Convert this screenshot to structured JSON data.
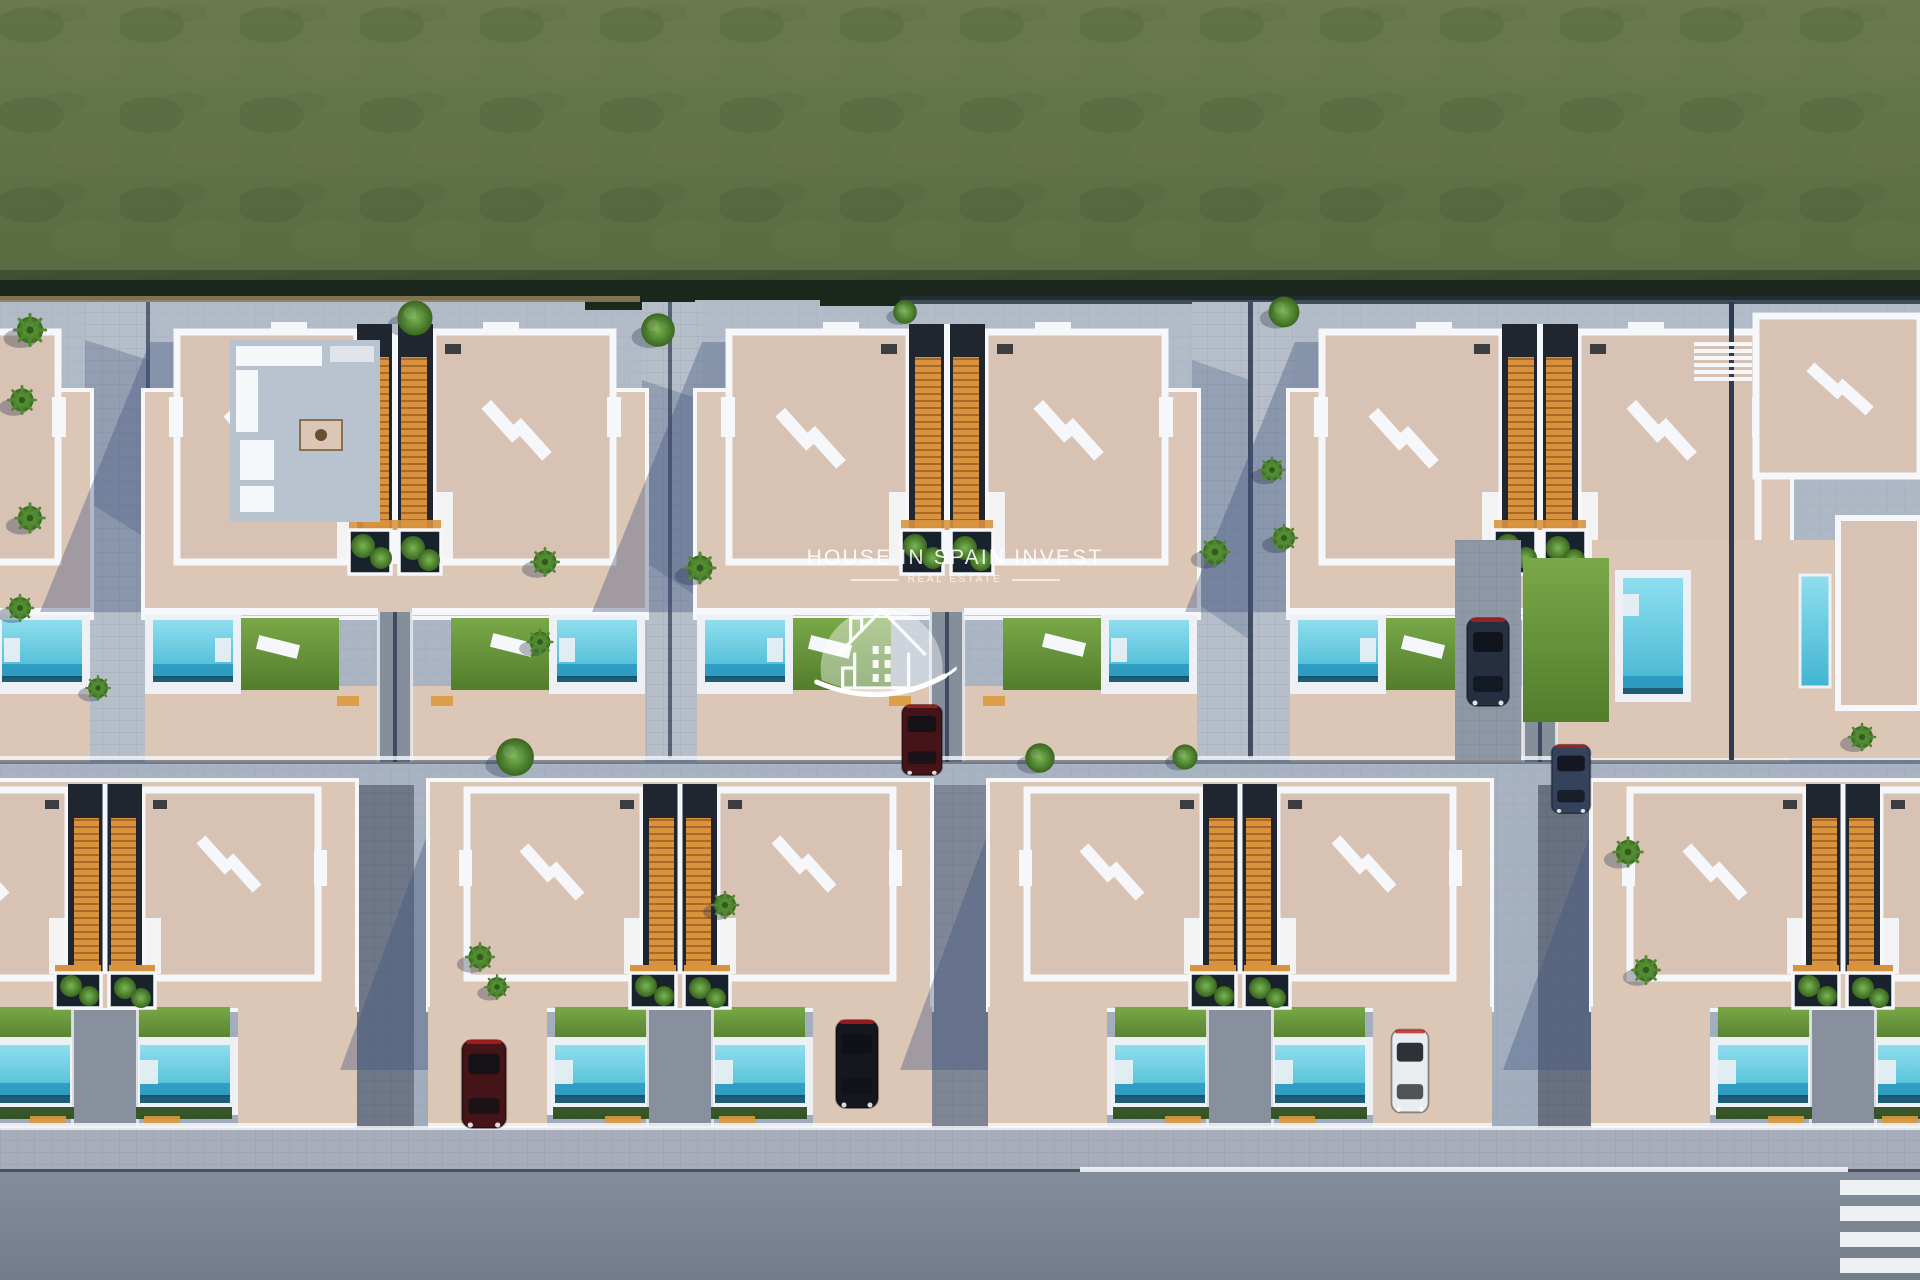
{
  "watermark": {
    "title": "HOUSE IN SPAIN INVEST",
    "subtitle": "REAL ESTATE",
    "logo": "house-in-dome-with-swoosh"
  },
  "scene": {
    "type": "aerial-3d-render",
    "subject": "two rows of semi-detached villas with rooftop solariums, orange staircases, private pools, lawns and palm trees",
    "top": "green field",
    "bottom": "asphalt road with white edge line and pedestrian crossing",
    "vehicles": [
      "dark car",
      "dark blue car",
      "black car",
      "dark red car",
      "white car",
      "dark red car"
    ]
  },
  "palette": {
    "field": "#64744a",
    "fieldEdge": "#1c271b",
    "topWall": "#8d7c58",
    "concrete": "#aab4c2",
    "shadow": "#42557e",
    "terrace": "#dcc7b7",
    "roof": "#d7c2b3",
    "white": "#f5f7fa",
    "corridor": "#20262f",
    "stairs": "#d9933e",
    "planter": "#18222c",
    "hedge": "#2e4d1f",
    "deck": "#edf1f5",
    "path": "#b6bec9",
    "navyWall": "#2e3a52",
    "orange": "#d99a3c",
    "sidewalk": "#a7adbb",
    "road": "#7c8593",
    "marking": "#eef1f4",
    "curb": "#49525f",
    "poolDeep": "#2491bb",
    "poolDark": "#10374f",
    "carDark": "#262f40",
    "carBlue": "#35425c",
    "carBlack": "#14171e",
    "carRed": "#451418",
    "carWhite": "#e9edf0",
    "glass": "#9fb2c8",
    "glassDark": "#0d1117"
  }
}
